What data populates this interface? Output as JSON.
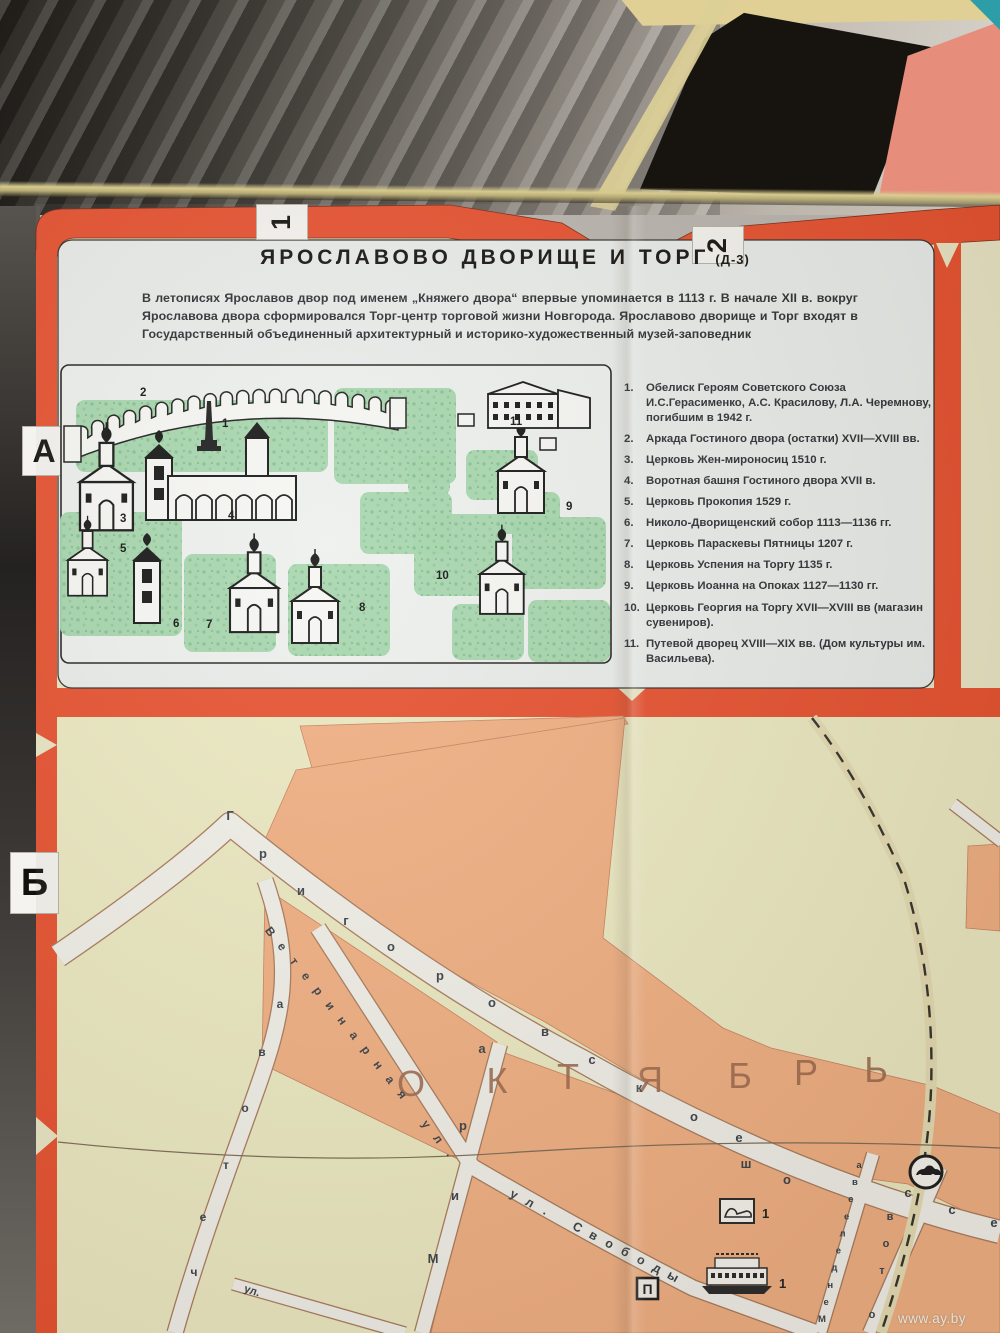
{
  "watermark": "www.ay.by",
  "grid": {
    "top_tabs": [
      "1",
      "2"
    ],
    "side_tabs": [
      "А",
      "Б"
    ]
  },
  "card": {
    "title": "ЯРОСЛАВОВО ДВОРИЩЕ И ТОРГ",
    "title_suffix": "(Д-3)",
    "intro": "В летописях Ярославов двор под именем „Княжего двора“ впервые упоминается в 1113 г. В начале XII в. вокруг Ярославова двора сформировался Торг-центр торговой жизни Новгорода. Ярославово дворище и Торг входят в Государственный объединенный архитектурный и историко-художественный музей-заповедник",
    "legend_items": [
      "Обелиск Героям Советского Союза И.С.Герасименко, А.С. Красилову, Л.А. Черемнову, погибшим в 1942 г.",
      "Аркада Гостиного двора (остатки) XVII—XVIII вв.",
      "Церковь Жен-мироносиц 1510 г.",
      "Воротная башня Гостиного двора XVII в.",
      "Церковь Прокопия 1529 г.",
      "Николо-Дворищенский собор 1113—1136 гг.",
      "Церковь Параскевы Пятницы 1207 г.",
      "Церковь Успения на Торгу 1135 г.",
      "Церковь Иоанна на Опоках 1127—1130 гг.",
      "Церковь Георгия на Торгу XVII—XVIII вв (магазин сувениров).",
      "Путевой дворец XVIII—XIX вв. (Дом культуры им. Васильева)."
    ],
    "illustration_marker_numbers": [
      "1",
      "2",
      "3",
      "4",
      "5",
      "6",
      "7",
      "8",
      "9",
      "10",
      "11"
    ]
  },
  "map": {
    "district_letters": "ОКТЯБРЬ",
    "streets": [
      {
        "id": "grigorovskoe",
        "label": "Григоровское"
      },
      {
        "id": "shosse",
        "label": "шоссе"
      },
      {
        "id": "veterinarnaya",
        "label": "Ветеринарная ул."
      },
      {
        "id": "svobody",
        "label": "ул. Свободы"
      },
      {
        "id": "kochetova",
        "label": "четова",
        "reverse": true
      },
      {
        "id": "mira",
        "label": "Мира",
        "reverse": true
      },
      {
        "id": "mendeleeva",
        "label": "Менделеева",
        "reverse": true
      },
      {
        "id": "otov",
        "label": "отов",
        "reverse": true
      },
      {
        "id": "ul_branch",
        "label": "ул."
      }
    ],
    "icons": {
      "p_marker": "П",
      "shoe_number": "1",
      "ship_number": "1"
    }
  }
}
